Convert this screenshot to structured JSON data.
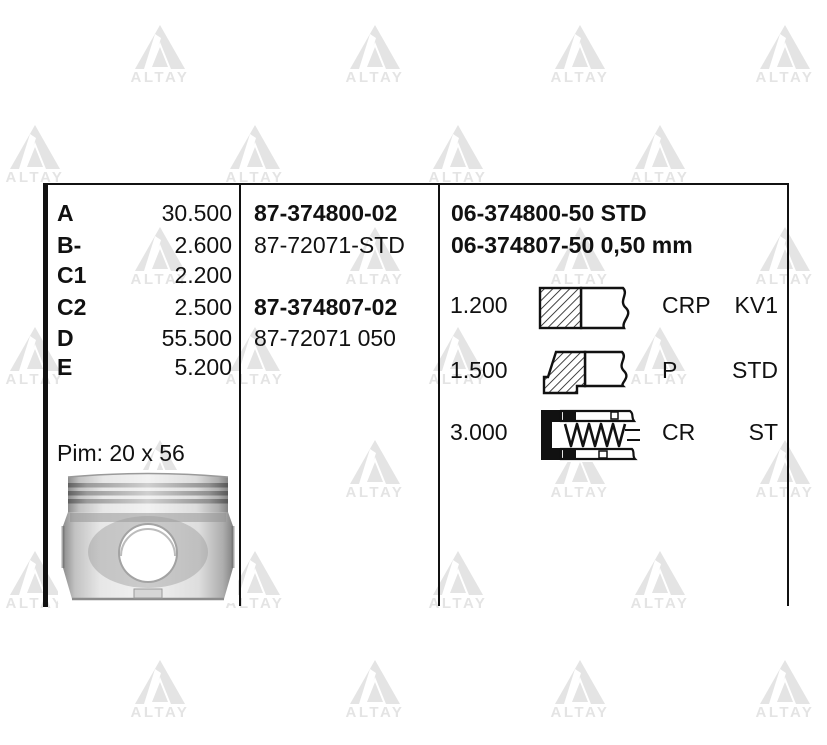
{
  "watermark": {
    "text": "ALTAY",
    "color": "#e4e4e4",
    "rows": [
      {
        "y": 60,
        "xs": [
          160,
          375,
          580,
          785
        ]
      },
      {
        "y": 160,
        "xs": [
          35,
          255,
          458,
          660
        ]
      },
      {
        "y": 262,
        "xs": [
          160,
          375,
          580,
          785
        ]
      },
      {
        "y": 362,
        "xs": [
          35,
          255,
          458,
          660
        ]
      },
      {
        "y": 475,
        "xs": [
          160,
          375,
          580,
          785
        ]
      },
      {
        "y": 586,
        "xs": [
          35,
          255,
          458,
          660
        ]
      },
      {
        "y": 695,
        "xs": [
          160,
          375,
          580,
          785
        ]
      }
    ]
  },
  "dimensions": {
    "rows": [
      {
        "label": "A",
        "value": "30.500"
      },
      {
        "label": "B-",
        "value": "2.600"
      },
      {
        "label": "C1",
        "value": "2.200"
      },
      {
        "label": "C2",
        "value": "2.500"
      },
      {
        "label": "D",
        "value": "55.500"
      },
      {
        "label": "E",
        "value": "5.200"
      }
    ],
    "pin_label": "Pim: 20 x 56"
  },
  "piston_numbers": [
    {
      "text": "87-374800-02",
      "bold": true
    },
    {
      "text": "87-72071-STD",
      "bold": false
    },
    {
      "text": "87-374807-02",
      "bold": true
    },
    {
      "text": "87-72071 050",
      "bold": false
    }
  ],
  "ring_set_numbers": [
    "06-374800-50 STD",
    "06-374807-50 0,50 mm"
  ],
  "rings": [
    {
      "size": "1.200",
      "type": "CRP",
      "spec": "KV1"
    },
    {
      "size": "1.500",
      "type": "P",
      "spec": "STD"
    },
    {
      "size": "3.000",
      "type": "CR",
      "spec": "ST"
    }
  ]
}
